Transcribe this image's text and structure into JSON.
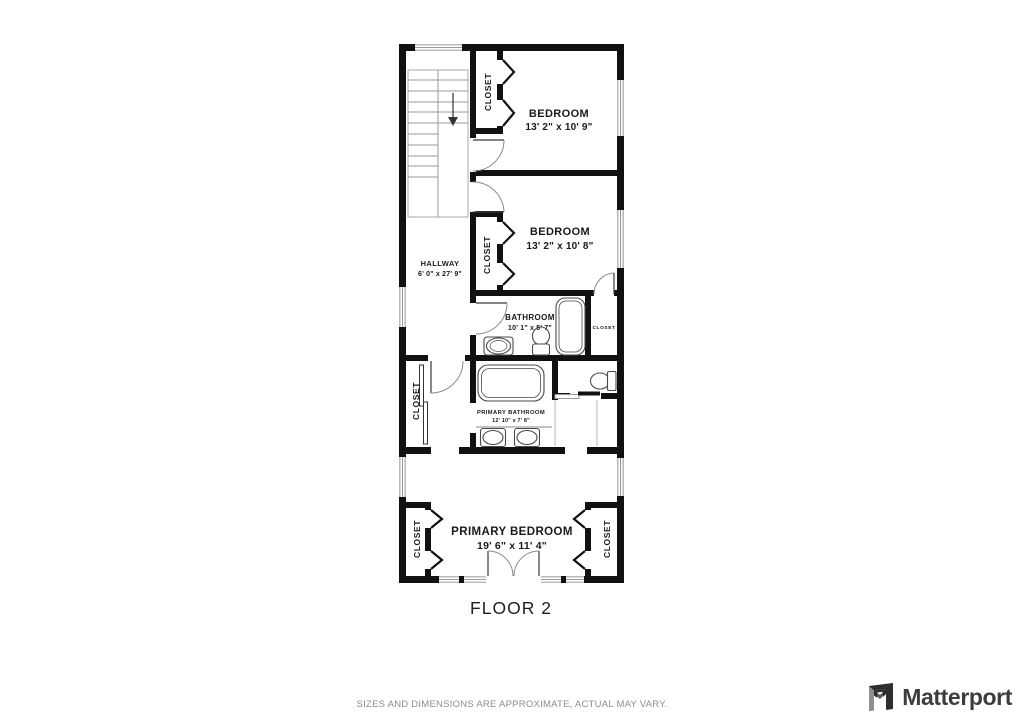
{
  "floorplan": {
    "floor_label": "FLOOR 2",
    "rooms": {
      "bedroom1": {
        "name": "BEDROOM",
        "dims": "13' 2\" x 10' 9\""
      },
      "bedroom2": {
        "name": "BEDROOM",
        "dims": "13' 2\" x 10' 8\""
      },
      "hallway": {
        "name": "HALLWAY",
        "dims": "6' 0\" x 27' 9\""
      },
      "bathroom": {
        "name": "BATHROOM",
        "dims": "10' 1\" x 5' 7\""
      },
      "primary_bathroom": {
        "name": "PRIMARY BATHROOM",
        "dims": "12' 10\" x 7' 8\""
      },
      "primary_bedroom": {
        "name": "PRIMARY BEDROOM",
        "dims": "19' 6\" x 11' 4\""
      },
      "closet": {
        "name": "CLOSET"
      }
    },
    "colors": {
      "wall": "#111111",
      "background": "#ffffff",
      "fixture_line": "#4a4a4a",
      "thin_line": "#9a9a9a",
      "label_text": "#1a1a1a"
    }
  },
  "footer": {
    "disclaimer": "SIZES AND DIMENSIONS ARE APPROXIMATE, ACTUAL MAY VARY.",
    "brand": "Matterport",
    "brand_color": "#3d3d3d",
    "disclaimer_color": "#8d8d8d"
  }
}
